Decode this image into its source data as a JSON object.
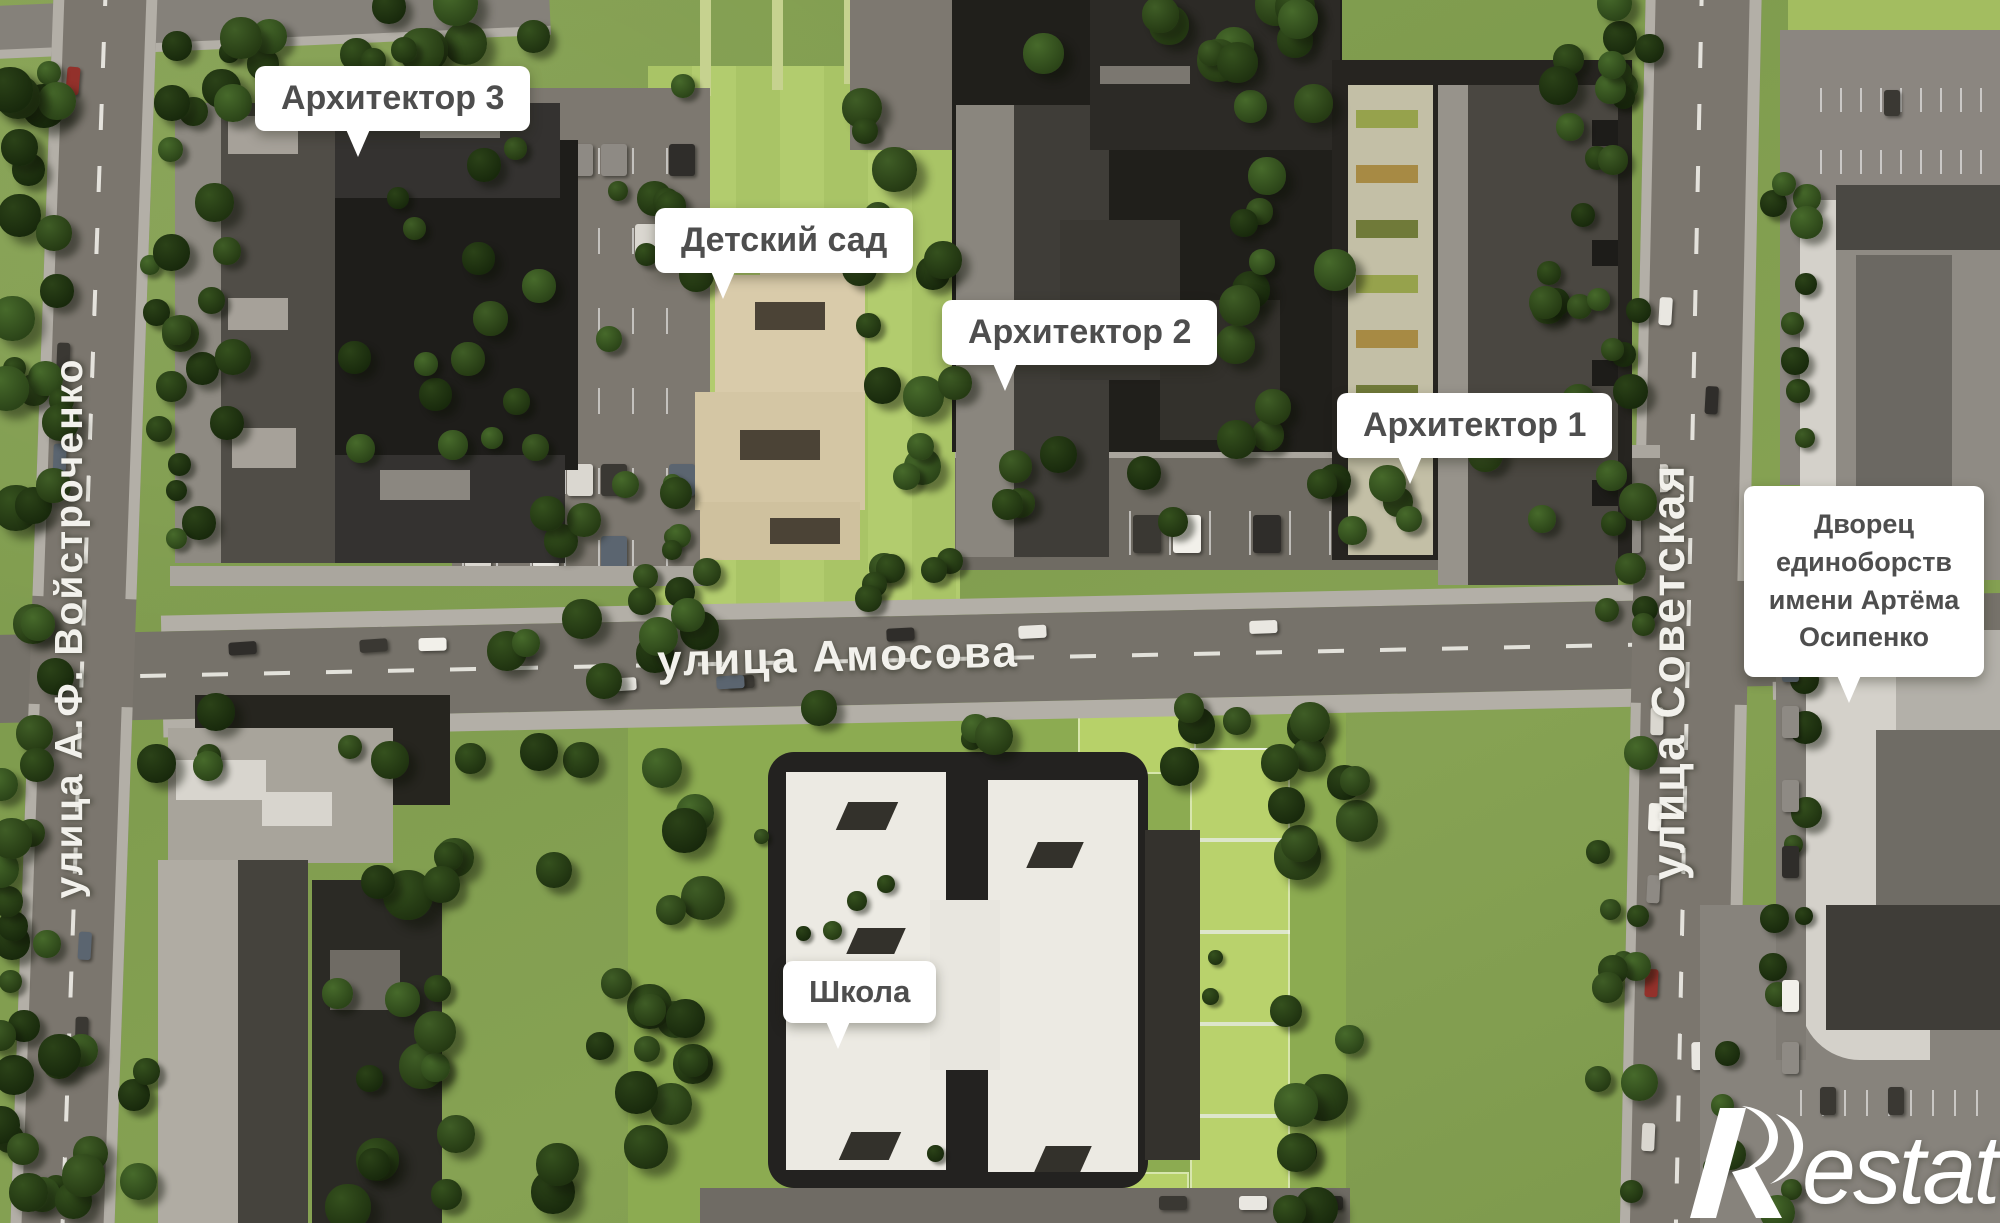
{
  "scene": {
    "kind": "aerial-masterplan-render",
    "labels": {
      "architect3": "Архитектор 3",
      "kindergarten": "Детский сад",
      "architect2": "Архитектор 2",
      "architect1": "Архитектор 1",
      "palace": "Дворец единоборств имени Артёма Осипенко",
      "school": "Школа"
    },
    "streets": {
      "voystrochenko": "улица А.Ф. Войстроченко",
      "amosova": "улица Амосова",
      "sovetskaya": "улица Советская"
    },
    "watermark": {
      "brand": "Restate",
      "wordmark_rest": "estate"
    },
    "colors": {
      "grass": "#82a050",
      "lawn_light": "#aac466",
      "sport_field": "#b9d26c",
      "asphalt": "#76726a",
      "sidewalk": "#b3afa7",
      "building_dark": "#23221e",
      "building_gray": "#8b8780",
      "kindergarten_beige": "#d7c9a8",
      "school_white": "#edebe4",
      "label_bg": "#ffffff",
      "label_text": "#4e4e4e",
      "tree_green": "#35511e"
    }
  }
}
